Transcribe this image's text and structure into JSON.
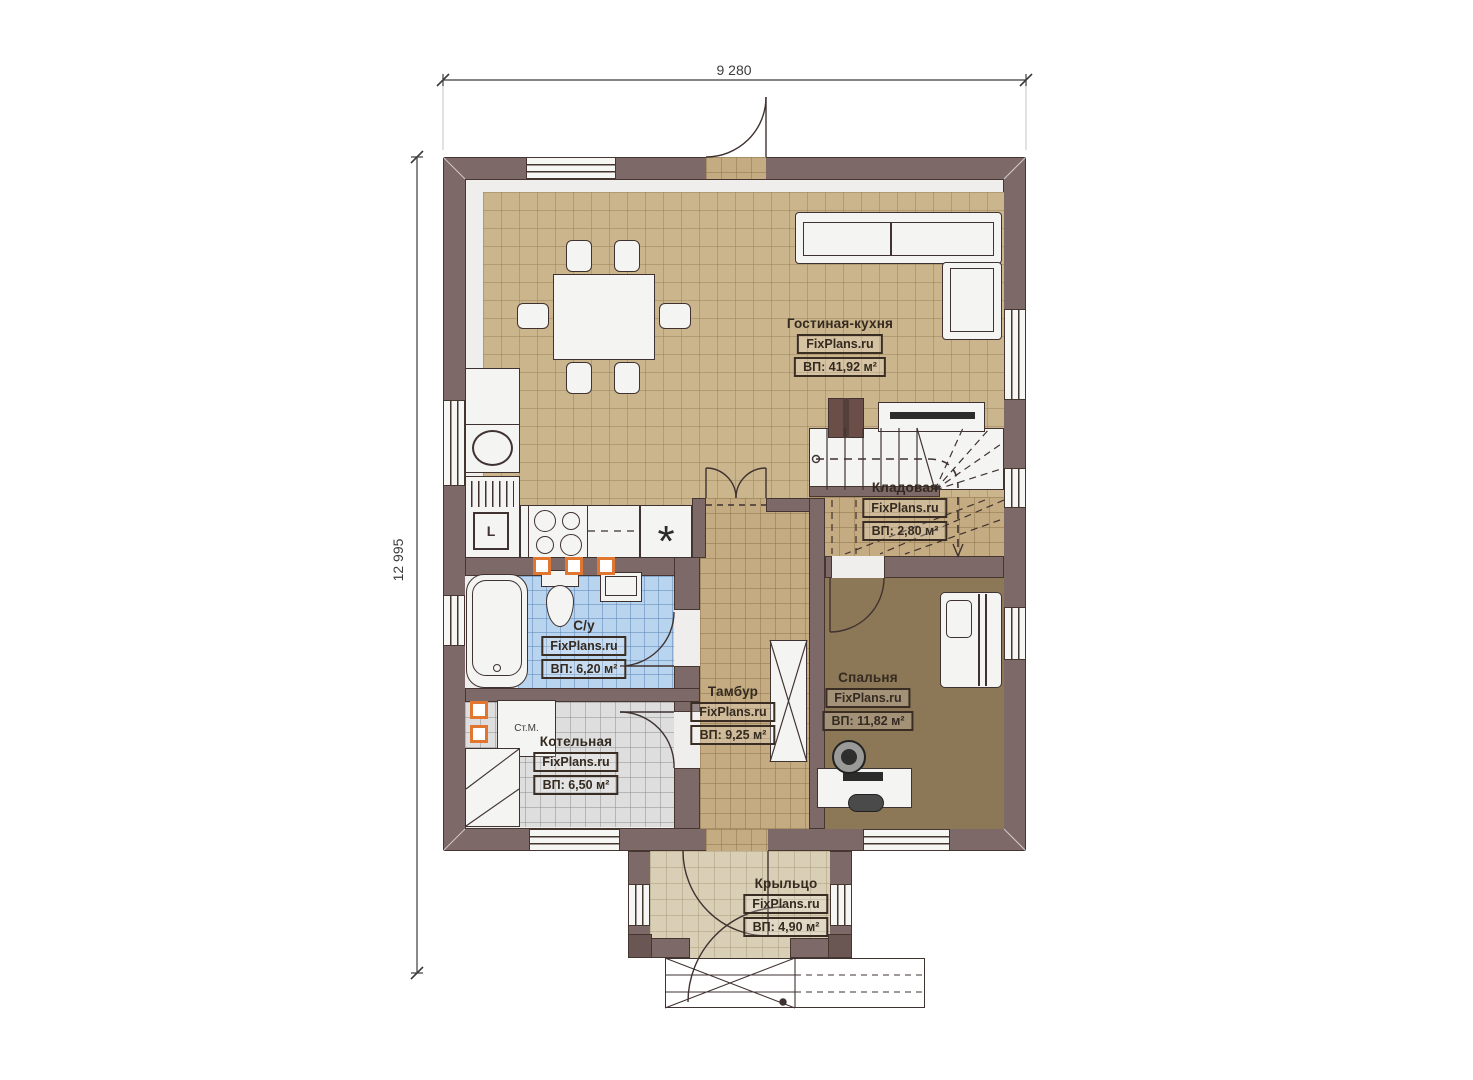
{
  "plan": {
    "dimension_width": "9 280",
    "dimension_height": "12 995"
  },
  "rooms": {
    "living": {
      "name": "Гостиная-кухня",
      "brand": "FixPlans.ru",
      "area": "ВП: 41,92 м²"
    },
    "storage": {
      "name": "Кладовая",
      "brand": "FixPlans.ru",
      "area": "ВП: 2,80 м²"
    },
    "bathroom": {
      "name": "С/у",
      "brand": "FixPlans.ru",
      "area": "ВП: 6,20 м²"
    },
    "hallway": {
      "name": "Тамбур",
      "brand": "FixPlans.ru",
      "area": "ВП: 9,25 м²"
    },
    "bedroom": {
      "name": "Спальня",
      "brand": "FixPlans.ru",
      "area": "ВП: 11,82 м²"
    },
    "boiler": {
      "name": "Котельная",
      "brand": "FixPlans.ru",
      "area": "ВП: 6,50 м²"
    },
    "porch": {
      "name": "Крыльцо",
      "brand": "FixPlans.ru",
      "area": "ВП: 4,90 м²"
    }
  },
  "equipment": {
    "washing_machine": "Ст.М.",
    "boiler_unit": "L",
    "freezer_symbol": "*"
  },
  "colors": {
    "wall": "#7c6968",
    "outline": "#45362f",
    "floor_tan": "#cbb58c",
    "floor_hall": "#c4ab81",
    "floor_blue": "#b9d4ee",
    "floor_gray": "#dedede",
    "floor_bedroom": "#8c7757",
    "floor_porch": "#d9cfb6",
    "accent_orange": "#e0762f"
  }
}
